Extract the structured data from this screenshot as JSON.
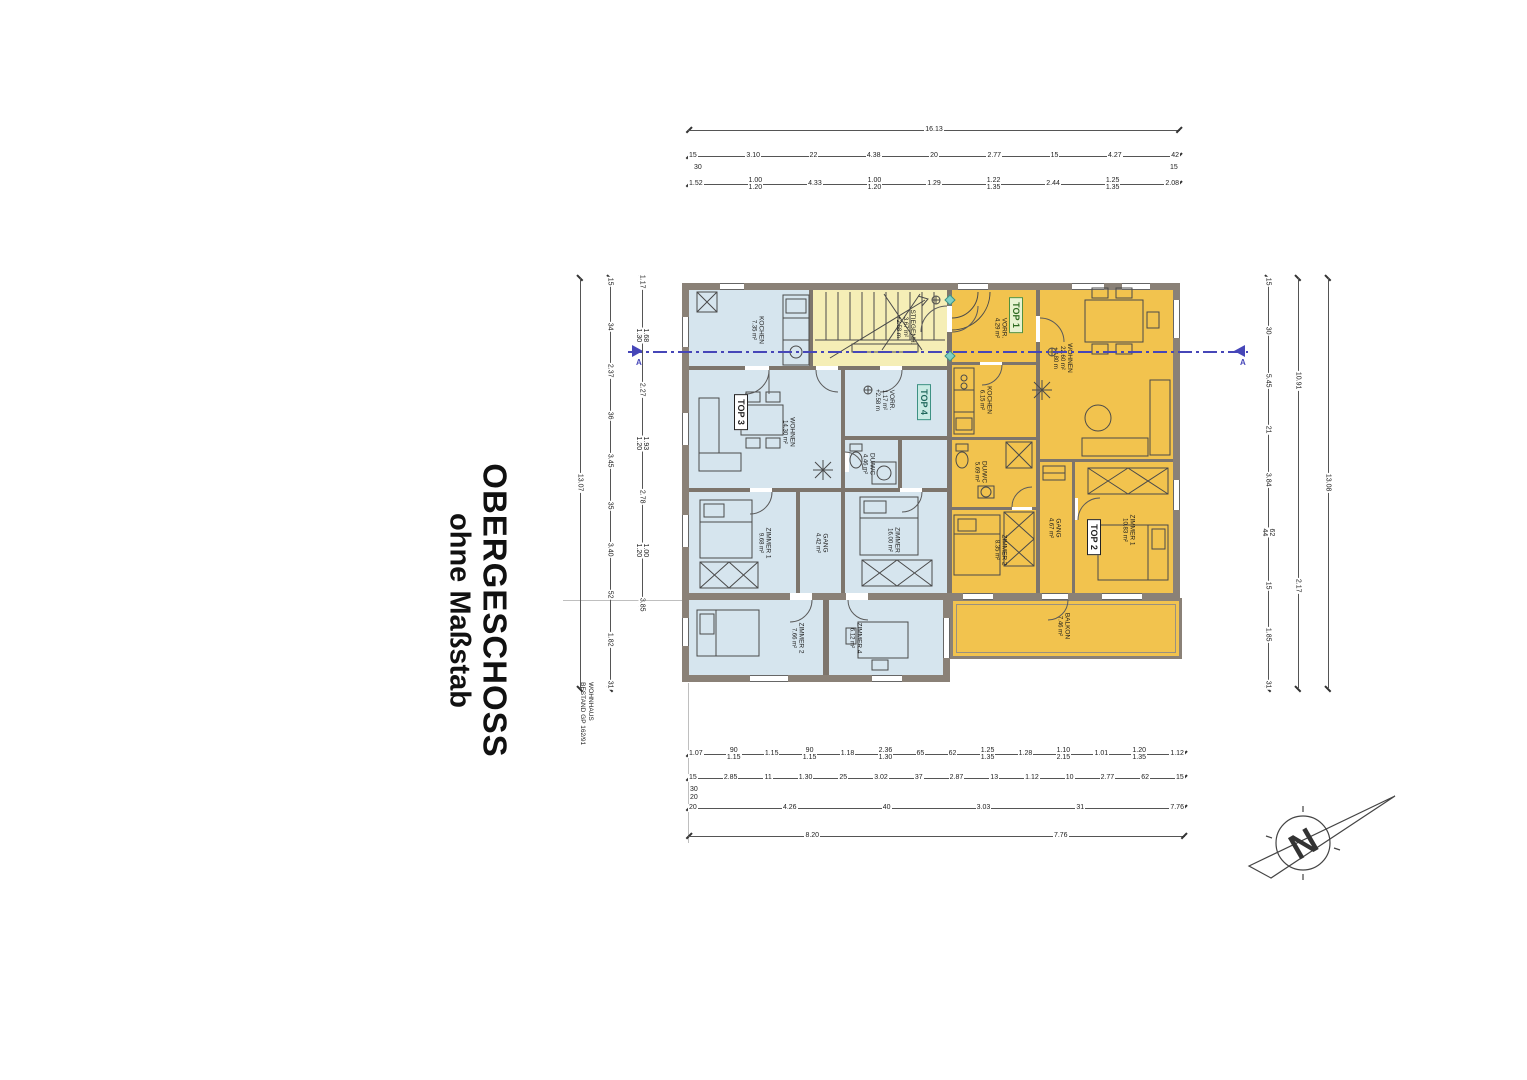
{
  "title": {
    "line1": "OBERGESCHOSS",
    "line2": "ohne Maßstab"
  },
  "note": {
    "line1": "WOHNHAUS",
    "line2": "BESTAND GP 162/91"
  },
  "section_marker": "A",
  "north_label": "N",
  "colors": {
    "wall": "#8a8177",
    "blue_room": "#d6e5ee",
    "yellow_stair": "#f5eeb6",
    "orange_room": "#f2c34e",
    "section_blue": "#4646b8"
  },
  "top_labels": {
    "top1": "TOP 1",
    "top2": "TOP 2",
    "top3": "TOP 3",
    "top4": "TOP 4"
  },
  "rooms": {
    "t3_kochen": {
      "name": "KOCHEN",
      "area": "7.35 m²"
    },
    "stiege": {
      "name": "STIEGENH.",
      "area": "3.67 m²",
      "extra": "+2.58 m"
    },
    "t3_wohnen": {
      "name": "WOHNEN",
      "area": "14.30 m²"
    },
    "t3_zimmer1": {
      "name": "ZIMMER 1",
      "area": "9.68 m²"
    },
    "t3_gang": {
      "name": "GANG",
      "area": "4.42 m²"
    },
    "t4_vorr": {
      "name": "VORR.",
      "area": "1.17 m²",
      "extra": "+2.58 m"
    },
    "t4_duwc": {
      "name": "DU/WC",
      "area": "4.46 m²"
    },
    "t4_zimmer": {
      "name": "ZIMMER",
      "area": "16.00 m²"
    },
    "wing_z2": {
      "name": "ZIMMER 2",
      "area": "7.66 m²"
    },
    "wing_z4": {
      "name": "ZIMMER 4",
      "area": "6.12 m²"
    },
    "t1_vorr": {
      "name": "VORR.",
      "area": "4.29 m²"
    },
    "t1_kochen": {
      "name": "KOCHEN",
      "area": "6.15 m²"
    },
    "t1_wohnen": {
      "name": "WOHNEN",
      "area": "22.60 m²",
      "extra": "+2.80 m"
    },
    "t1_duwc": {
      "name": "DU/WC",
      "area": "5.69 m²"
    },
    "t1_zimmer2": {
      "name": "ZIMMER 2",
      "area": "8.35 m²"
    },
    "t2_gang": {
      "name": "GANG",
      "area": "4.67 m²"
    },
    "t2_zimmer1": {
      "name": "ZIMMER 1",
      "area": "10.83 m²"
    },
    "balkon": {
      "name": "BALKON",
      "area": "7.46 m²"
    }
  },
  "dimensions": {
    "top1": [
      "16.13"
    ],
    "top2": [
      "15",
      "3.10",
      "22",
      "4.38",
      "20",
      "2.77",
      "15",
      "4.27",
      "42"
    ],
    "top2_sub_left": "30",
    "top2_sub_right": "15",
    "top3": [
      "1.52",
      "1.00|1.20",
      "4.33",
      "1.00|1.20",
      "1.29",
      "1.22|1.35",
      "2.44",
      "1.25|1.35",
      "2.08"
    ],
    "bottom1": [
      "1.07",
      "90|1.15",
      "1.15",
      "90|1.15",
      "1.18",
      "2.36|1.30",
      "65",
      "62",
      "1.25|1.35",
      "1.28",
      "1.10|2.15",
      "1.01",
      "1.20|1.35",
      "1.12"
    ],
    "bottom2": [
      "15",
      "2.85",
      "11",
      "1.30",
      "25",
      "3.02",
      "37",
      "2.87",
      "13",
      "1.12",
      "10",
      "2.77",
      "62",
      "15"
    ],
    "bottom2_sub_a": "30",
    "bottom2_sub_b": "20",
    "bottom3": [
      "20",
      "4.26",
      "40",
      "3.03",
      "31",
      "7.76"
    ],
    "bottom4": [
      "8.20",
      "7.76"
    ],
    "left1": [
      "13.07"
    ],
    "left2": [
      "15",
      "34",
      "2.37",
      "36",
      "3.45",
      "35",
      "3.40",
      "52",
      "1.82",
      "31"
    ],
    "left3": [
      "1.17",
      "1.68|1.30",
      "2.27",
      "1.93|1.20",
      "2.78",
      "1.00|1.20",
      "3.85"
    ],
    "right1": [
      "15",
      "30",
      "5.45",
      "21",
      "3.84",
      "62|44",
      "15",
      "1.85",
      "31"
    ],
    "right2": [
      "10.91",
      "2.17"
    ],
    "right3": [
      "13.08"
    ]
  }
}
